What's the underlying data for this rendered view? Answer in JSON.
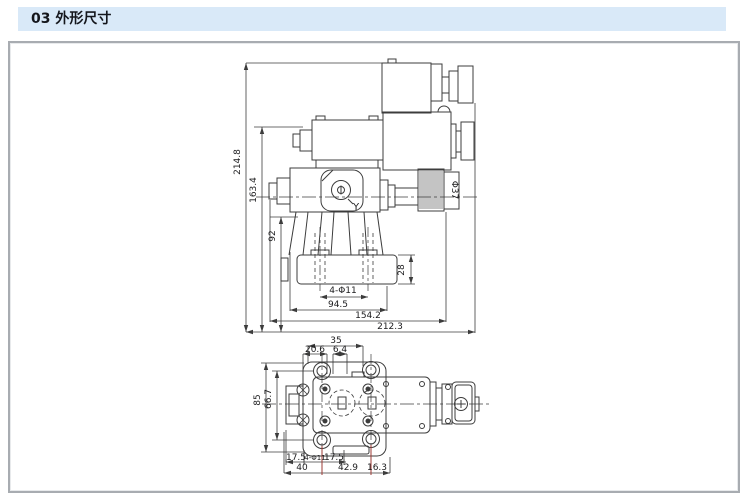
{
  "header": {
    "title": "03 外形尺寸"
  },
  "colors": {
    "line": "#3c3c3c",
    "extension_red": "#9c3b34",
    "header_bg": "#d9e9f8",
    "frame_border": "#a8acb1"
  },
  "side_view": {
    "port_label": "Y",
    "knob_dia": "Φ37",
    "dim_total_height": "214.8",
    "dim_height_163": "163.4",
    "dim_height_92": "92",
    "dim_base_height": "28",
    "dim_holes": "4-Φ11",
    "dim_width_94": "94.5",
    "dim_width_154": "154.2",
    "dim_width_212": "212.3"
  },
  "bottom_view": {
    "dim_35": "35",
    "dim_20_6": "20.6",
    "dim_6_4": "6.4",
    "dim_85": "85",
    "dim_66_7": "66.7",
    "dim_17_5_left": "17.5",
    "dim_holes": "4-Φ11",
    "dim_17_5_right": "17.5",
    "dim_40": "40",
    "dim_42_9": "42.9",
    "dim_16_3": "16.3"
  }
}
